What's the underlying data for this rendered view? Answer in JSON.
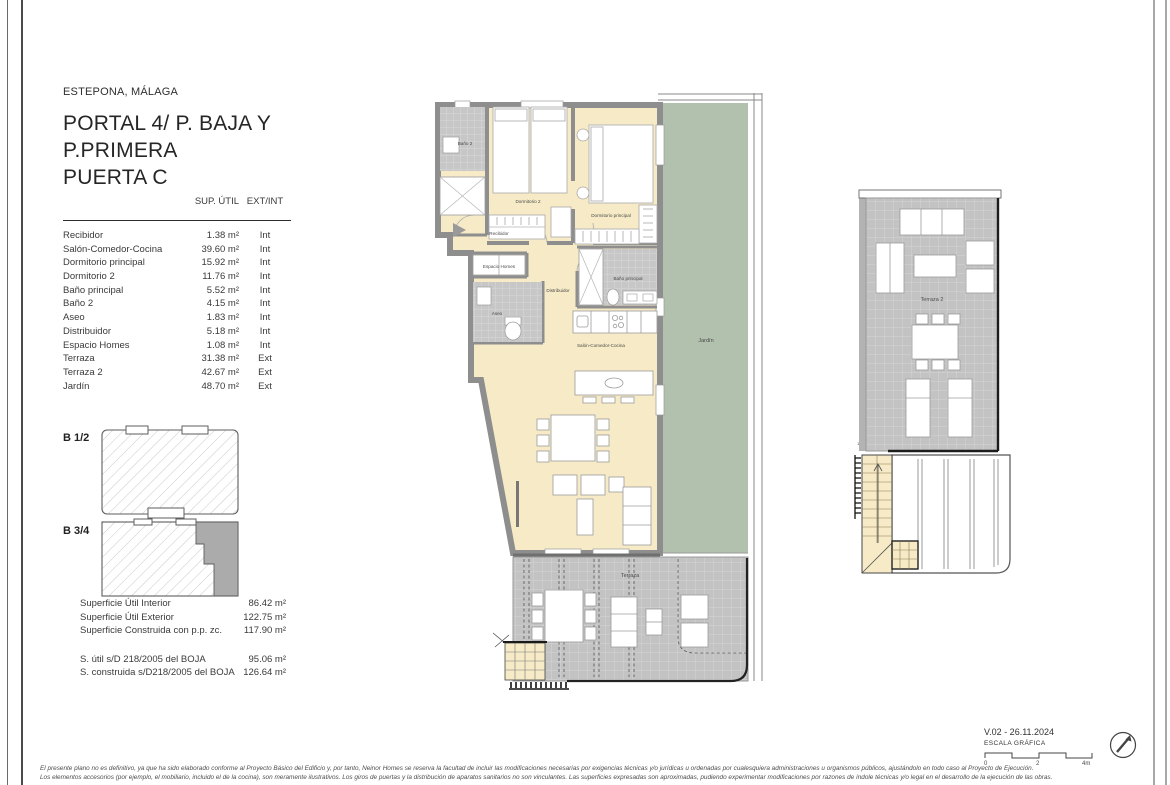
{
  "doc": {
    "location": "ESTEPONA, MÁLAGA",
    "title_lines": [
      "PORTAL 4/ P. BAJA Y",
      "P.PRIMERA",
      "PUERTA C"
    ]
  },
  "areas": {
    "header_sup": "SUP. ÚTIL",
    "header_extint": "EXT/INT",
    "rows": [
      {
        "name": "Recibidor",
        "area": "1.38 m²",
        "type": "Int"
      },
      {
        "name": "Salón-Comedor-Cocina",
        "area": "39.60 m²",
        "type": "Int"
      },
      {
        "name": "Dormitorio principal",
        "area": "15.92 m²",
        "type": "Int"
      },
      {
        "name": "Dormitorio 2",
        "area": "11.76 m²",
        "type": "Int"
      },
      {
        "name": "Baño principal",
        "area": "5.52 m²",
        "type": "Int"
      },
      {
        "name": "Baño 2",
        "area": "4.15 m²",
        "type": "Int"
      },
      {
        "name": "Aseo",
        "area": "1.83 m²",
        "type": "Int"
      },
      {
        "name": "Distribuidor",
        "area": "5.18 m²",
        "type": "Int"
      },
      {
        "name": "Espacio Homes",
        "area": "1.08 m²",
        "type": "Int"
      },
      {
        "name": "Terraza",
        "area": "31.38 m²",
        "type": "Ext"
      },
      {
        "name": "Terraza 2",
        "area": "42.67 m²",
        "type": "Ext"
      },
      {
        "name": "Jardín",
        "area": "48.70 m²",
        "type": "Ext"
      }
    ]
  },
  "key_plans": {
    "b12_label": "B 1/2",
    "b34_label": "B 3/4"
  },
  "summary": {
    "rows": [
      {
        "label": "Superficie Útil Interior",
        "value": "86.42 m²"
      },
      {
        "label": "Superficie Útil Exterior",
        "value": "122.75 m²"
      },
      {
        "label": "Superficie Construida con p.p. zc.",
        "value": "117.90 m²"
      }
    ],
    "boja_rows": [
      {
        "label": "S. útil s/D 218/2005 del BOJA",
        "value": "95.06 m²"
      },
      {
        "label": "S. construida s/D218/2005 del BOJA",
        "value": "126.64 m²"
      }
    ]
  },
  "plan": {
    "labels": {
      "bano2": "Baño 2",
      "dormitorio2": "Dormitorio 2",
      "dormitorio_principal": "Dormitorio principal",
      "recibidor": "Recibidor",
      "espacio_homes": "Espacio Homes",
      "aseo": "Aseo",
      "distribuidor": "Distribuidor",
      "bano_principal": "Baño principal",
      "salon": "Salón-Comedor-Cocina",
      "jardin": "Jardín",
      "terraza": "Terraza",
      "terraza2": "Terraza 2",
      "stair_mark": "1"
    },
    "colors": {
      "interior_cream": "#F6EBC6",
      "garden_green": "#B2C1AD",
      "wall_gray": "#8E8E8E",
      "tile_gray": "#C7C7C7",
      "key_plan_dark": "#ABABAB"
    }
  },
  "footer": {
    "version": "V.02 - 26.11.2024",
    "scale_label": "ESCALA GRÁFICA",
    "scale_ticks": [
      "0",
      "2",
      "4m"
    ],
    "disclaimer": [
      "El presente plano no es definitivo, ya que ha sido elaborado conforme al Proyecto Básico del Edificio y, por tanto, Neinor Homes se reserva la facultad de incluir las modificaciones necesarias por exigencias técnicas y/o jurídicas u ordenadas por cualesquiera administraciones u organismos públicos, ajustándolo en todo caso al Proyecto de Ejecución.",
      "Los elementos accesorios (por ejemplo, el mobiliario, incluido el de la cocina), son meramente ilustrativos. Los giros de puertas y la distribución de aparatos sanitarios no son vinculantes. Las superficies expresadas son aproximadas, pudiendo experimentar modificaciones por razones de índole técnicas y/o legal en el desarrollo de la ejecución de las obras."
    ]
  }
}
